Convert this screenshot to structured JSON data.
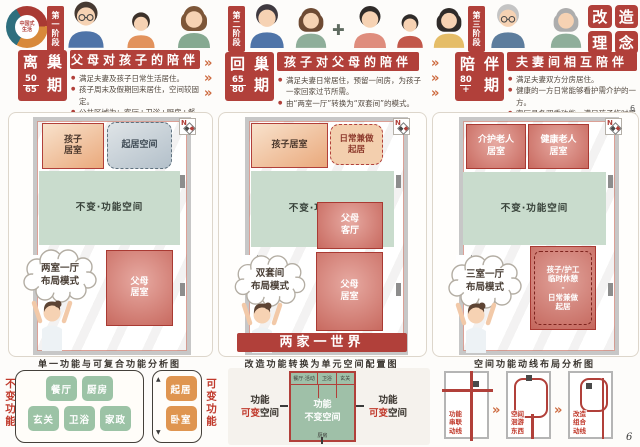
{
  "page": {
    "corner_top": "6",
    "corner_bottom": "6"
  },
  "logo": {
    "line1": "中国式",
    "line2": "生活"
  },
  "concept": {
    "chars": [
      "改",
      "造",
      "理",
      "念"
    ]
  },
  "phases": [
    {
      "tab": "第一阶段",
      "period": {
        "c1": "离",
        "c2": "巢",
        "c3": "期",
        "age_top": "50",
        "age_bottom": "65"
      },
      "title": "父母对孩子的陪伴",
      "bullets": [
        "满足夫妻及孩子日常生活居住。",
        "孩子周末及假期回来居住，空间较固定。",
        "公共区域为：客厅+卫浴+厨房+餐厅。"
      ]
    },
    {
      "tab": "第二阶段",
      "period": {
        "c1": "回",
        "c2": "巢",
        "c3": "期",
        "age_top": "65",
        "age_bottom": "80"
      },
      "title": "孩子对父母的陪伴",
      "bullets": [
        "满足夫妻日常居住，预留一间房，为孩子一家回家过节所需。",
        "由“两室一厅”转换为“双套间”的模式。"
      ]
    },
    {
      "tab": "第三阶段",
      "period": {
        "c1": "陪",
        "c2": "伴",
        "c3": "期",
        "age_top": "80",
        "age_bottom": "+"
      },
      "title": "夫妻间相互陪伴",
      "bullets": [
        "满足夫妻双方分房居住。",
        "健康的一方日常能够看护需介护的一方。",
        "客厅具备双重功能，满足孩子临时居住。"
      ]
    }
  ],
  "plans": [
    {
      "compass": "N",
      "room_child": {
        "l1": "孩子",
        "l2": "居室"
      },
      "room_living": "起居空间",
      "room_fixed": "不变·功能空间",
      "room_parent": {
        "l1": "父母",
        "l2": "居室"
      },
      "cloud": {
        "l1": "两室一厅",
        "l2": "布局模式"
      },
      "caption": "单一功能与可复合功能分析图"
    },
    {
      "compass": "N",
      "room_child": "孩子居室",
      "room_living": {
        "l1": "日常兼做",
        "l2": "起居"
      },
      "room_fixed": "不变·功能空间",
      "room_parent_hall": {
        "l1": "父母",
        "l2": "客厅"
      },
      "room_parent": {
        "l1": "父母",
        "l2": "居室"
      },
      "cloud": {
        "l1": "双套间",
        "l2": "布局模式"
      },
      "banner": "两家一世界",
      "caption": "改造功能转换为单元空间配置图"
    },
    {
      "compass": "N",
      "room_care": {
        "l1": "介护老人",
        "l2": "居室"
      },
      "room_healthy": {
        "l1": "健康老人",
        "l2": "居室"
      },
      "room_fixed": "不变·功能空间",
      "room_flex": {
        "l1": "孩子/护工",
        "l2": "临时休憩",
        "l3": "-",
        "l4": "日常兼做",
        "l5": "起居"
      },
      "cloud": {
        "l1": "三室一厅",
        "l2": "布局模式"
      },
      "caption": "空间功能动线布局分析图"
    }
  ],
  "legend_left": {
    "fixed_label": "不变功能",
    "fixed_tiles": [
      "餐厅",
      "厨房",
      "玄关",
      "卫浴",
      "家政"
    ],
    "variable_label": "可变功能",
    "variable_tiles": [
      "起居",
      "卧室"
    ]
  },
  "legend_middle": {
    "left_l1": "功能",
    "left_l2a": "可变",
    "left_l2b": "空间",
    "center_cells": [
      "餐厅·活动",
      "卫浴",
      "玄关"
    ],
    "center_l1": "功能",
    "center_l2": "不变空间",
    "center_bottom": "厨房",
    "right_l1": "功能",
    "right_l2a": "可变",
    "right_l2b": "空间"
  },
  "legend_right": {
    "items": [
      {
        "l1": "功能",
        "l2": "串联",
        "l3": "动线"
      },
      {
        "l1": "空间",
        "l2": "洄游",
        "l3": "东西"
      },
      {
        "l1": "改造",
        "l2": "组合",
        "l3": "动线"
      }
    ]
  }
}
